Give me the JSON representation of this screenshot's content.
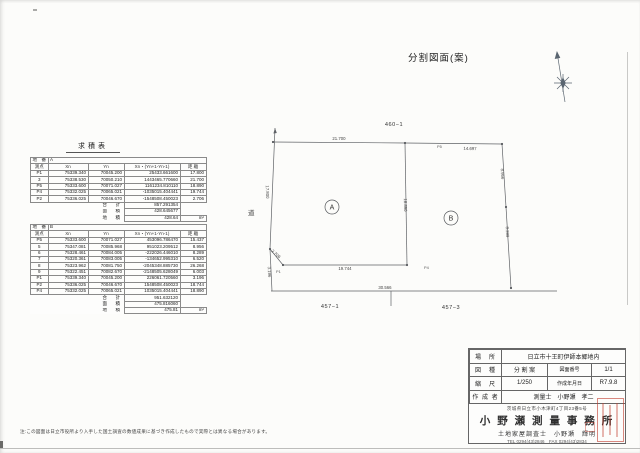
{
  "page": {
    "title": "分割図面(案)",
    "note": "注:この図面は日立市役所より入手した国土調査の数値成果に基づき作成したもので実際とは異なる場合があります。"
  },
  "area": {
    "heading": "求積表",
    "lot_label": "地　番",
    "col_headers": [
      "測点",
      "Xn",
      "Yn",
      "Xn・(Yn+1-Yn-1)",
      "距 離"
    ],
    "total_label": "合　計",
    "half_label": "面　積",
    "chiseki_label": "地　積",
    "unit": "m²",
    "tables": [
      {
        "lot": "A",
        "rows": [
          [
            "P1",
            "75339.340",
            "70045.200",
            "25433.661600",
            "17.800"
          ],
          [
            "3",
            "75338.530",
            "70050.210",
            "1443465.770660",
            "21.700"
          ],
          [
            "P5",
            "75333.600",
            "70071.027",
            "1161234.810110",
            "18.890"
          ],
          [
            "P4",
            "75332.025",
            "70065.021",
            "-1035015.404441",
            "19.744"
          ],
          [
            "P2",
            "75336.025",
            "70046.670",
            "-1548508.450023",
            "2.706"
          ]
        ],
        "total": "857.291354",
        "half": "428.645677",
        "chiseki": "428.64"
      },
      {
        "lot": "B",
        "rows": [
          [
            "P5",
            "75333.600",
            "70071.027",
            "453096.786470",
            "15.437"
          ],
          [
            "5",
            "75347.081",
            "70085.968",
            "951023.209512",
            "8.956"
          ],
          [
            "6",
            "75328.461",
            "70084.005",
            "-222026.446010",
            "8.289"
          ],
          [
            "7",
            "75320.361",
            "70083.005",
            "-134652.995310",
            "6.520"
          ],
          [
            "8",
            "75323.962",
            "70081.750",
            "-2045348.885730",
            "26.268"
          ],
          [
            "9",
            "75322.451",
            "70082.670",
            "-2148505.628049",
            "6.003"
          ],
          [
            "P1",
            "75339.340",
            "70045.200",
            "226061.720560",
            "3.196"
          ],
          [
            "P2",
            "75336.025",
            "70046.670",
            "1548508.450023",
            "18.744"
          ],
          [
            "P4",
            "75332.025",
            "70065.021",
            "1035015.404441",
            "18.890"
          ]
        ],
        "total": "951.632120",
        "half": "475.816060",
        "chiseki": "475.81"
      }
    ]
  },
  "drawing": {
    "lot_top": "460−1",
    "lot_bottom_left": "457−1",
    "lot_bottom_right": "457−3",
    "road": "道",
    "parcel_a": "A",
    "parcel_b": "B",
    "p5": "P5",
    "p4": "P4",
    "p1": "P1",
    "d_top_left": "21.700",
    "d_top_right": "14.697",
    "d_left": "17.800",
    "d_left_low": "3.196",
    "d_diag": "2.706",
    "d_bottom": "19.744",
    "d_divider": "18.890",
    "d_right_up": "8.956",
    "d_right_low": "8.289",
    "d_road": "30.566"
  },
  "title_block": {
    "loc_label": "場　所",
    "loc": "日立市十王町伊師本郷地内",
    "type_label": "図　種",
    "type": "分 割 案",
    "num_label": "図面番号",
    "num": "1/1",
    "scale_label": "縮　尺",
    "scale": "1/250",
    "date_label": "作成年月日",
    "date": "R7.9.8",
    "author_label": "作 成 者",
    "author": "測量士　小野瀬　孝二",
    "address": "茨城県日立市小木津町4丁目23番5号",
    "office": "小 野 瀬 測 量 事 務 所",
    "surveyor": "土地家屋調査士　小野瀬　輝明",
    "tel": "TEL 0294(43)2846　FAX 0294(43)2834"
  }
}
